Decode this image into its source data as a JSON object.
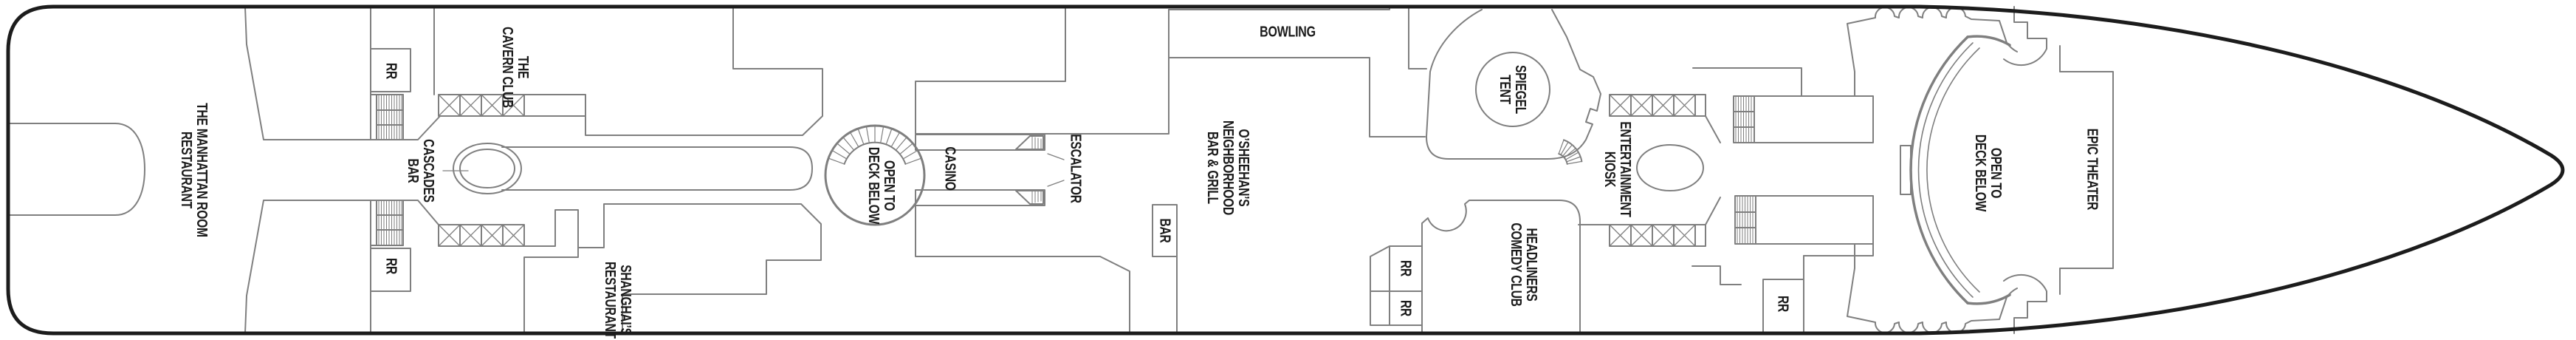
{
  "plan": {
    "kind": "ship deck plan",
    "colors": {
      "background": "#ffffff",
      "hull_outline": "#1c1c1c",
      "interior_lines": "#7f7f7f",
      "label_text": "#1b1b1b"
    },
    "symbols": {
      "stairs-icon": "hatched rectangle with tread lines",
      "stairwell-x-icon": "rectangle of X-crossed cells",
      "escalator-icon": "stepped parallelogram with tread hatching",
      "deck-opening": "circle with curved stair fan",
      "spiral-stairs-icon": "radial fan of treads",
      "kiosk-oval": "oval counter",
      "bar-counter": "racetrack ring with long counter band"
    }
  },
  "venues": [
    {
      "id": "manhattan-room",
      "label": "THE MANHATTAN ROOM\nRESTAURANT"
    },
    {
      "id": "rr-aft-top",
      "label": "RR"
    },
    {
      "id": "cavern-club",
      "label": "THE\nCAVERN CLUB"
    },
    {
      "id": "cascades-bar",
      "label": "CASCADES\nBAR"
    },
    {
      "id": "rr-aft-bottom",
      "label": "RR"
    },
    {
      "id": "shanghais-restaurant",
      "label": "SHANGHAI’S\nRESTAURANT"
    },
    {
      "id": "casino-opening",
      "label": "OPEN TO\nDECK BELOW"
    },
    {
      "id": "casino",
      "label": "CASINO"
    },
    {
      "id": "escalator",
      "label": "ESCALATOR"
    },
    {
      "id": "bar",
      "label": "BAR"
    },
    {
      "id": "osheehans",
      "label": "O’SHEEHAN’S\nNEIGHBORHOOD\nBAR & GRILL"
    },
    {
      "id": "bowling",
      "label": "BOWLING"
    },
    {
      "id": "spiegel-tent",
      "label": "SPIEGEL\nTENT"
    },
    {
      "id": "rr-mid-top",
      "label": "RR"
    },
    {
      "id": "rr-mid-bottom",
      "label": "RR"
    },
    {
      "id": "headliners",
      "label": "HEADLINERS\nCOMEDY CLUB"
    },
    {
      "id": "entertainment-kiosk",
      "label": "ENTERTAINMENT\nKIOSK"
    },
    {
      "id": "rr-forward",
      "label": "RR"
    },
    {
      "id": "theater-opening",
      "label": "OPEN TO\nDECK BELOW"
    },
    {
      "id": "epic-theater",
      "label": "EPIC THEATER"
    }
  ]
}
